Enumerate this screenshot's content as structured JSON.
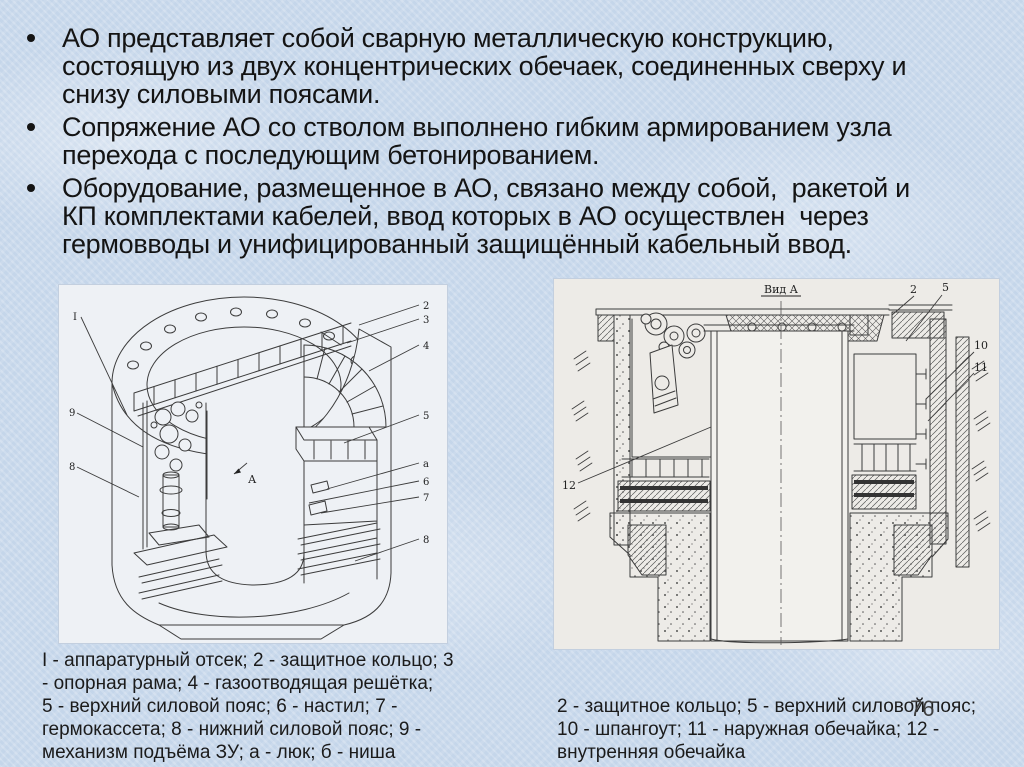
{
  "slide": {
    "page_number": "76",
    "bullets": [
      {
        "lines": [
          "АО представляет собой сварную металлическую конструкцию,",
          "состоящую из двух концентрических обечаек, соединенных сверху и",
          "снизу силовыми поясами."
        ]
      },
      {
        "lines": [
          "Сопряжение АО со стволом выполнено гибким армированием узла",
          "перехода с последующим бетонированием."
        ]
      },
      {
        "lines": [
          "Оборудование, размещенное в АО, связано между собой,  ракетой и",
          "КП комплектами кабелей, ввод которых в АО осуществлен  через",
          "гермовводы и унифицированный защищённый кабельный ввод."
        ]
      }
    ]
  },
  "left_figure": {
    "left_labels": [
      "I",
      "9",
      "8"
    ],
    "right_labels": [
      "2",
      "3",
      "4",
      "5",
      "а",
      "6",
      "7",
      "8"
    ],
    "view_arrow_label": "А",
    "caption_lines": [
      "I - аппаратурный отсек; 2 - защитное кольцо; 3",
      "- опорная рама; 4 - газоотводящая решётка;",
      "5 - верхний силовой пояс; 6 - настил; 7 -",
      "гермокассета; 8 - нижний силовой пояс; 9 -",
      "механизм подъёма ЗУ; а - люк; б - ниша"
    ]
  },
  "right_figure": {
    "view_label": "Вид А",
    "top_labels": [
      "2",
      "5"
    ],
    "right_labels": [
      "10",
      "11"
    ],
    "left_label": "12",
    "caption_lines": [
      "2 - защитное кольцо; 5 - верхний силовой пояс;",
      "10 - шпангоут; 11 - наружная обечайка; 12 -",
      "внутренняя обечайка"
    ]
  },
  "colors": {
    "slide_background": "#ccdbed",
    "text": "#141414",
    "left_figure_background": "#eef1f5",
    "right_figure_background": "#edebe7",
    "drawing_line": "#3c3c3c"
  }
}
